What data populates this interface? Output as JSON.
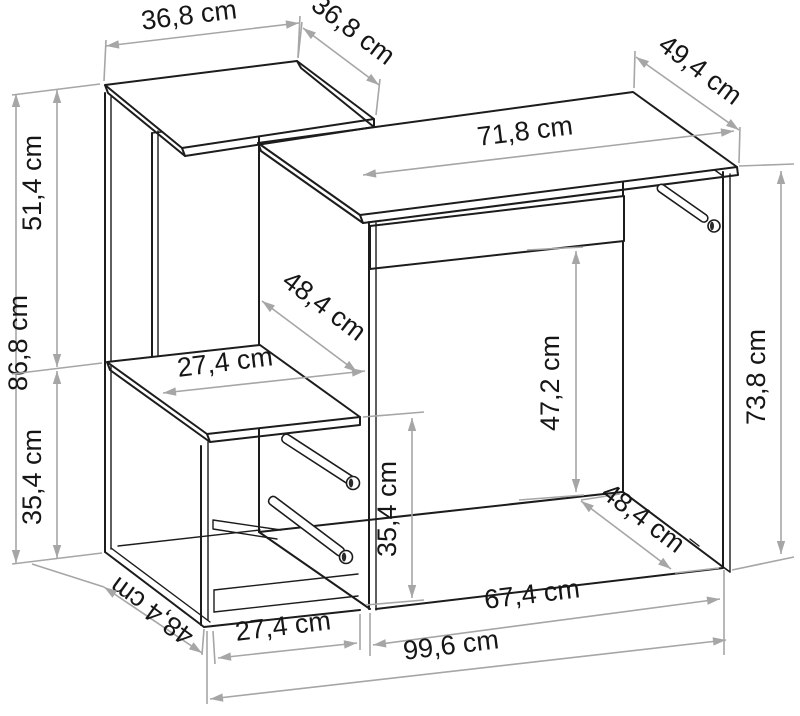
{
  "figure": {
    "kind": "furniture-dimension-diagram",
    "subject": "desk-with-shelf-and-drawer-unit",
    "unit": "cm",
    "colors": {
      "outline": "#1c1c1c",
      "dimension": "#a6a6a6",
      "label": "#161616",
      "background": "#ffffff"
    },
    "dims": {
      "top_shelf_width": "36,8 cm",
      "top_shelf_depth": "36,8 cm",
      "desktop_depth": "49,4 cm",
      "desktop_width": "71,8 cm",
      "left_total_height": "86,8 cm",
      "left_upper_height": "51,4 cm",
      "left_lower_height": "35,4 cm",
      "middle_shelf_width": "27,4 cm",
      "middle_section_depth": "48,4 cm",
      "knee_clearance_height": "47,2 cm",
      "desk_side_height": "73,8 cm",
      "drawer_opening_height": "35,4 cm",
      "cabinet_bottom_depth": "48,4 cm",
      "cabinet_width": "27,4 cm",
      "knee_space_width": "67,4 cm",
      "overall_width": "99,6 cm",
      "desk_side_depth": "48,4 cm"
    }
  }
}
